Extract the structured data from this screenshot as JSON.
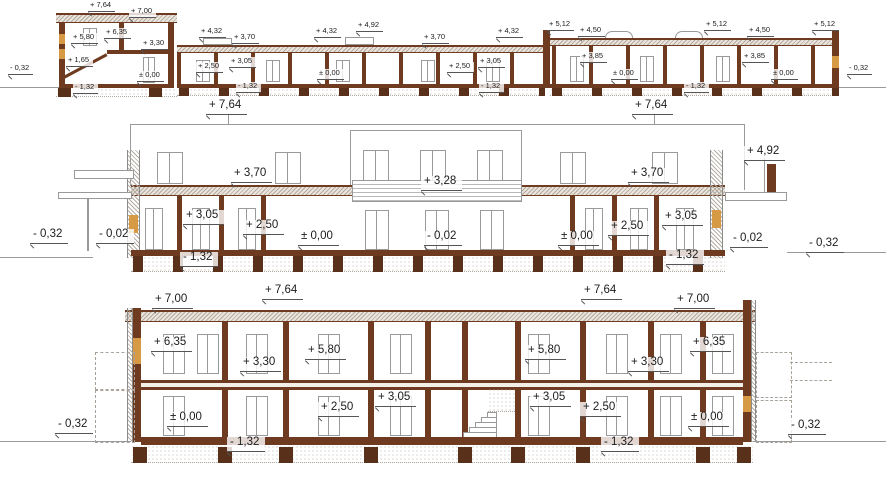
{
  "drawing": {
    "kind": "building cross-sections with elevation levels",
    "colors": {
      "wall_brown": "#6e3a20",
      "footing_brown": "#59301a",
      "timber_accent": "#d69a44",
      "line_gray": "#9a9a9a",
      "text": "#1c1c1c",
      "hatch": "#b5aa9d"
    },
    "sections": [
      {
        "id": "section-top",
        "labels": [
          {
            "text": "+ 7,64",
            "x": 88,
            "y": 1
          },
          {
            "text": "+ 7,00",
            "x": 129,
            "y": 7
          },
          {
            "text": "+ 5,80",
            "x": 71,
            "y": 33
          },
          {
            "text": "+ 6,35",
            "x": 104,
            "y": 28
          },
          {
            "text": "+ 3,30",
            "x": 141,
            "y": 39
          },
          {
            "text": "+ 1,65",
            "x": 66,
            "y": 56
          },
          {
            "text": "± 0,00",
            "x": 137,
            "y": 71
          },
          {
            "text": "- 1,32",
            "x": 73,
            "y": 83
          },
          {
            "text": "+ 4,32",
            "x": 199,
            "y": 27
          },
          {
            "text": "+ 3,70",
            "x": 232,
            "y": 33
          },
          {
            "text": "+ 4,32",
            "x": 314,
            "y": 27
          },
          {
            "text": "+ 4,92",
            "x": 356,
            "y": 21
          },
          {
            "text": "+ 3,70",
            "x": 422,
            "y": 33
          },
          {
            "text": "+ 4,32",
            "x": 496,
            "y": 27
          },
          {
            "text": "+ 5,12",
            "x": 547,
            "y": 20
          },
          {
            "text": "+ 4,50",
            "x": 578,
            "y": 26
          },
          {
            "text": "+ 5,12",
            "x": 704,
            "y": 20
          },
          {
            "text": "+ 4,50",
            "x": 747,
            "y": 26
          },
          {
            "text": "+ 5,12",
            "x": 812,
            "y": 20
          },
          {
            "text": "+ 2,50",
            "x": 196,
            "y": 62
          },
          {
            "text": "+ 3,05",
            "x": 229,
            "y": 57
          },
          {
            "text": "± 0,00",
            "x": 317,
            "y": 69
          },
          {
            "text": "+ 2,50",
            "x": 447,
            "y": 62
          },
          {
            "text": "+ 3,05",
            "x": 478,
            "y": 57
          },
          {
            "text": "+ 3,85",
            "x": 580,
            "y": 52
          },
          {
            "text": "± 0,00",
            "x": 611,
            "y": 69
          },
          {
            "text": "+ 3,85",
            "x": 742,
            "y": 52
          },
          {
            "text": "± 0,00",
            "x": 771,
            "y": 69
          },
          {
            "text": "- 1,32",
            "x": 236,
            "y": 82
          },
          {
            "text": "- 1,32",
            "x": 479,
            "y": 82
          },
          {
            "text": "- 1,32",
            "x": 684,
            "y": 82
          },
          {
            "text": "- 0,32",
            "x": 8,
            "y": 64
          },
          {
            "text": "- 0,32",
            "x": 847,
            "y": 64
          }
        ]
      },
      {
        "id": "section-middle",
        "labels": [
          {
            "text": "+ 7,64",
            "x": 206,
            "y": 100
          },
          {
            "text": "+ 7,64",
            "x": 632,
            "y": 100
          },
          {
            "text": "+ 4,92",
            "x": 744,
            "y": 146
          },
          {
            "text": "+ 3,70",
            "x": 231,
            "y": 168
          },
          {
            "text": "+ 3,28",
            "x": 421,
            "y": 176
          },
          {
            "text": "+ 3,70",
            "x": 628,
            "y": 168
          },
          {
            "text": "+ 3,05",
            "x": 183,
            "y": 210
          },
          {
            "text": "+ 2,50",
            "x": 243,
            "y": 220
          },
          {
            "text": "± 0,00",
            "x": 298,
            "y": 231
          },
          {
            "text": "- 0,02",
            "x": 424,
            "y": 231
          },
          {
            "text": "± 0,00",
            "x": 558,
            "y": 231
          },
          {
            "text": "+ 2,50",
            "x": 608,
            "y": 221
          },
          {
            "text": "+ 3,05",
            "x": 662,
            "y": 211
          },
          {
            "text": "- 0,02",
            "x": 96,
            "y": 229
          },
          {
            "text": "- 0,32",
            "x": 30,
            "y": 229
          },
          {
            "text": "- 0,02",
            "x": 730,
            "y": 233
          },
          {
            "text": "- 0,32",
            "x": 806,
            "y": 238
          },
          {
            "text": "- 1,32",
            "x": 180,
            "y": 252
          },
          {
            "text": "- 1,32",
            "x": 666,
            "y": 250
          }
        ]
      },
      {
        "id": "section-bottom",
        "labels": [
          {
            "text": "+ 7,00",
            "x": 152,
            "y": 294
          },
          {
            "text": "+ 7,64",
            "x": 262,
            "y": 285
          },
          {
            "text": "+ 7,64",
            "x": 581,
            "y": 285
          },
          {
            "text": "+ 7,00",
            "x": 674,
            "y": 294
          },
          {
            "text": "+ 6,35",
            "x": 151,
            "y": 337
          },
          {
            "text": "+ 3,30",
            "x": 240,
            "y": 357
          },
          {
            "text": "+ 5,80",
            "x": 305,
            "y": 345
          },
          {
            "text": "+ 5,80",
            "x": 525,
            "y": 345
          },
          {
            "text": "+ 3,30",
            "x": 628,
            "y": 357
          },
          {
            "text": "+ 6,35",
            "x": 690,
            "y": 337
          },
          {
            "text": "± 0,00",
            "x": 167,
            "y": 412
          },
          {
            "text": "+ 2,50",
            "x": 318,
            "y": 402
          },
          {
            "text": "+ 3,05",
            "x": 375,
            "y": 392
          },
          {
            "text": "+ 3,05",
            "x": 530,
            "y": 392
          },
          {
            "text": "+ 2,50",
            "x": 580,
            "y": 402
          },
          {
            "text": "± 0,00",
            "x": 688,
            "y": 412
          },
          {
            "text": "- 1,32",
            "x": 227,
            "y": 437
          },
          {
            "text": "- 1,32",
            "x": 601,
            "y": 437
          },
          {
            "text": "- 0,32",
            "x": 55,
            "y": 419
          },
          {
            "text": "- 0,32",
            "x": 788,
            "y": 420
          }
        ]
      }
    ]
  }
}
